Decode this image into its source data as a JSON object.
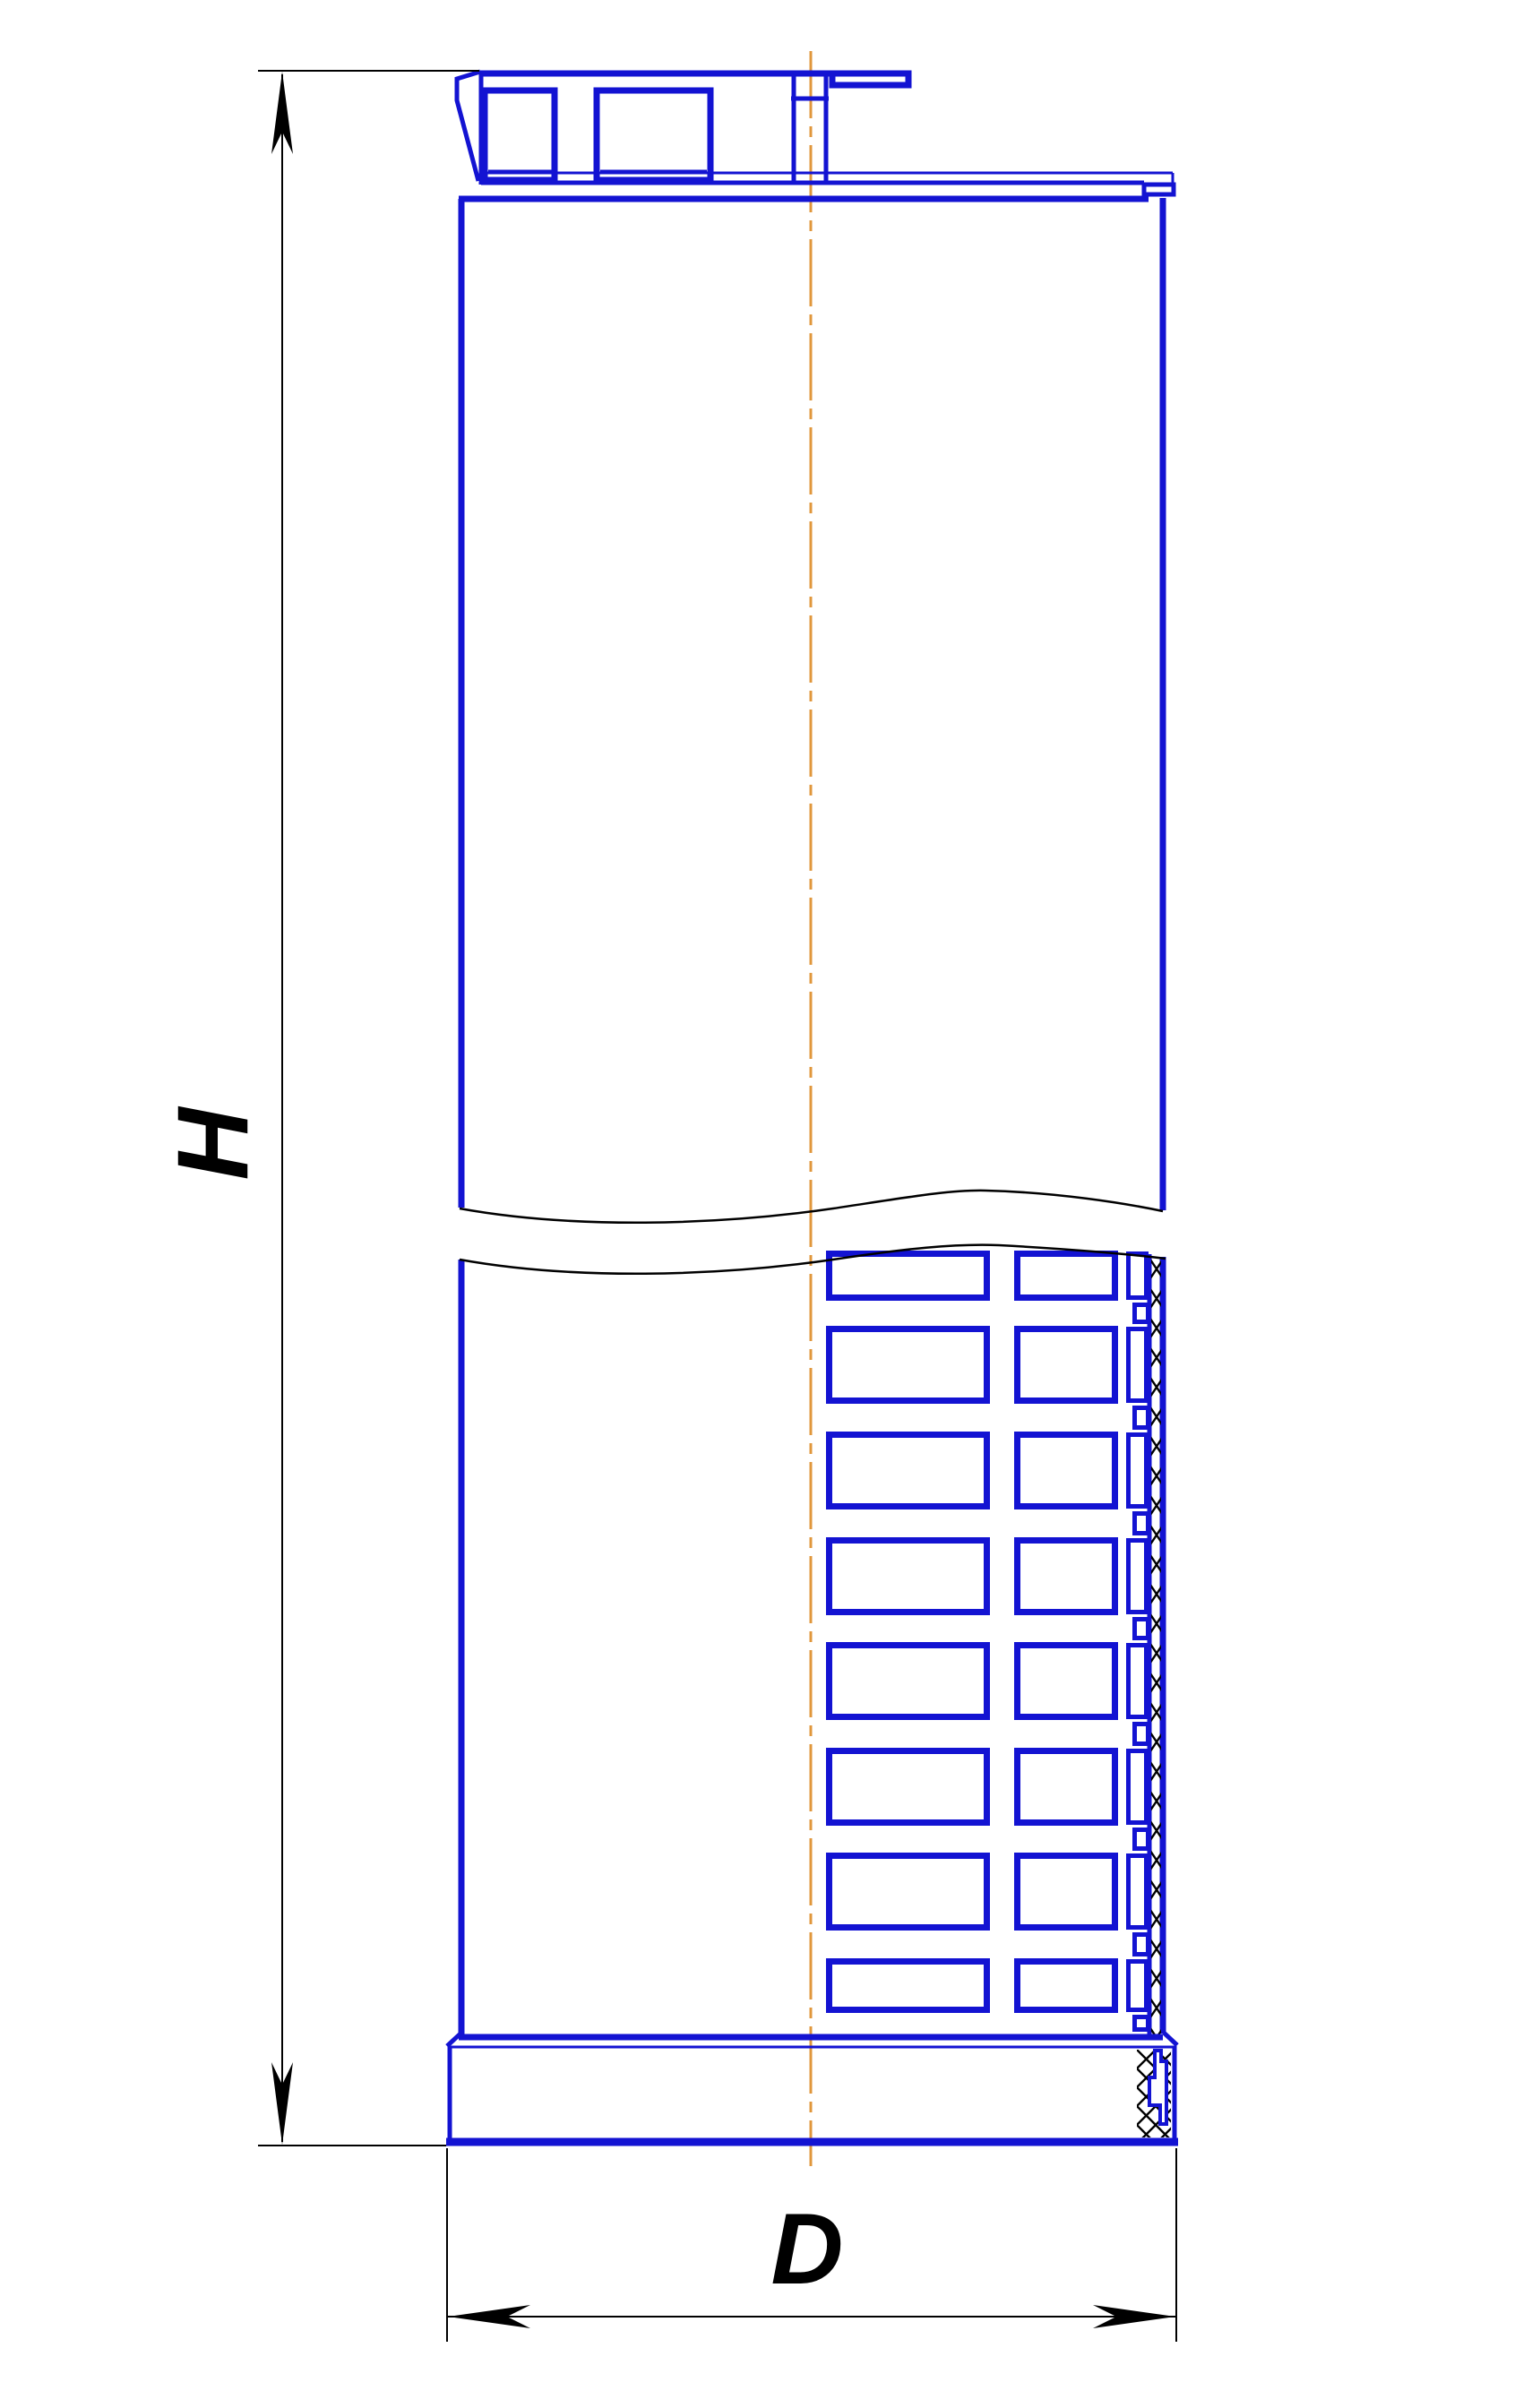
{
  "drawing": {
    "type": "engineering-drawing",
    "view": "filter-element-half-section-with-break",
    "labels": {
      "height": "H",
      "diameter": "D"
    },
    "colors": {
      "line_blue": "#1313d2",
      "centerline_orange": "#e0973c",
      "dimension_black": "#000000",
      "background": "#ffffff"
    }
  }
}
